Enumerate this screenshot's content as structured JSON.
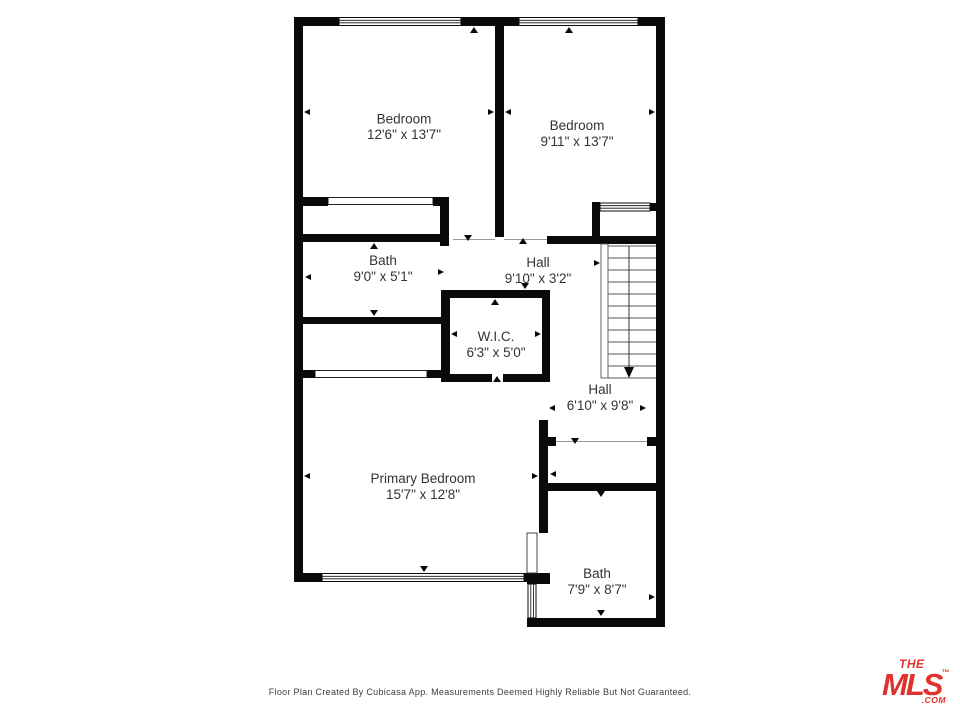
{
  "plan": {
    "rooms": [
      {
        "name": "Bedroom",
        "dims": "12'6\" x 13'7\""
      },
      {
        "name": "Bedroom",
        "dims": "9'11\" x 13'7\""
      },
      {
        "name": "Bath",
        "dims": "9'0\" x 5'1\""
      },
      {
        "name": "Hall",
        "dims": "9'10\" x 3'2\""
      },
      {
        "name": "W.I.C.",
        "dims": "6'3\" x 5'0\""
      },
      {
        "name": "Hall",
        "dims": "6'10\" x 9'8\""
      },
      {
        "name": "Primary Bedroom",
        "dims": "15'7\" x 12'8\""
      },
      {
        "name": "Bath",
        "dims": "7'9\" x 8'7\""
      }
    ],
    "stairs_direction": "down"
  },
  "footer": {
    "disclaimer": "Floor Plan Created By Cubicasa App. Measurements Deemed Highly Reliable But Not Guaranteed."
  },
  "logo": {
    "the": "THE",
    "mls": "MLS",
    "tm": "™",
    "com": ".COM"
  },
  "colors": {
    "wall": "#0a0a0a",
    "label": "#333333",
    "logo_red": "#E0322C"
  }
}
